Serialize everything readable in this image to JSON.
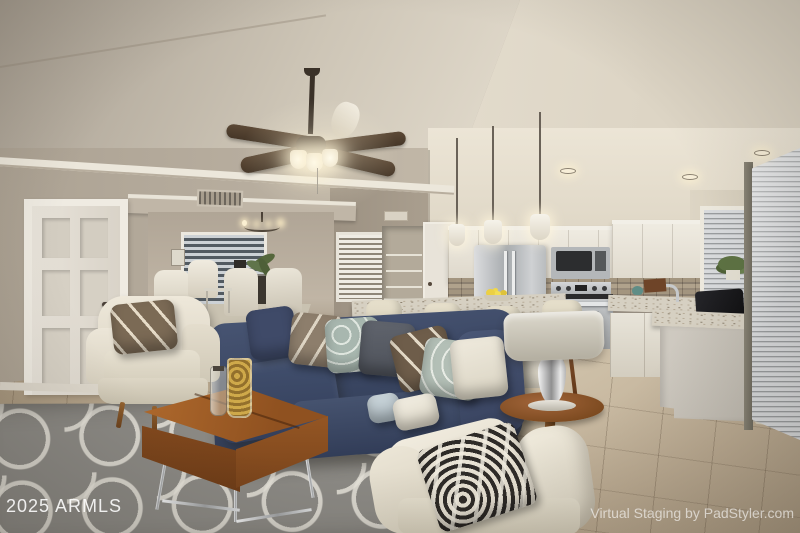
{
  "scene": {
    "kind": "real-estate interior photograph, virtually staged",
    "areas": [
      "vaulted living room",
      "open kitchen",
      "back sitting nook"
    ]
  },
  "watermarks": {
    "year_mls": "2025 ARMLS",
    "staging_credit": "Virtual Staging by PadStyler.com"
  },
  "palette": {
    "ceiling_cream": "#e6dfd1",
    "wall_greige": "#b5ab9c",
    "wall_tan": "#a3988a",
    "cabinet_white": "#e9e4d9",
    "sofa_navy": "#3a4563",
    "rug_gray": "#8b8984",
    "rug_pattern_white": "#e4e1d8",
    "wood_walnut": "#96551f",
    "floor_travertine": "#b3a28c",
    "stainless_steel": "#b9bcbe",
    "blinds_silver": "#c9cbcd",
    "granite_counter": "#d6d0c2"
  }
}
